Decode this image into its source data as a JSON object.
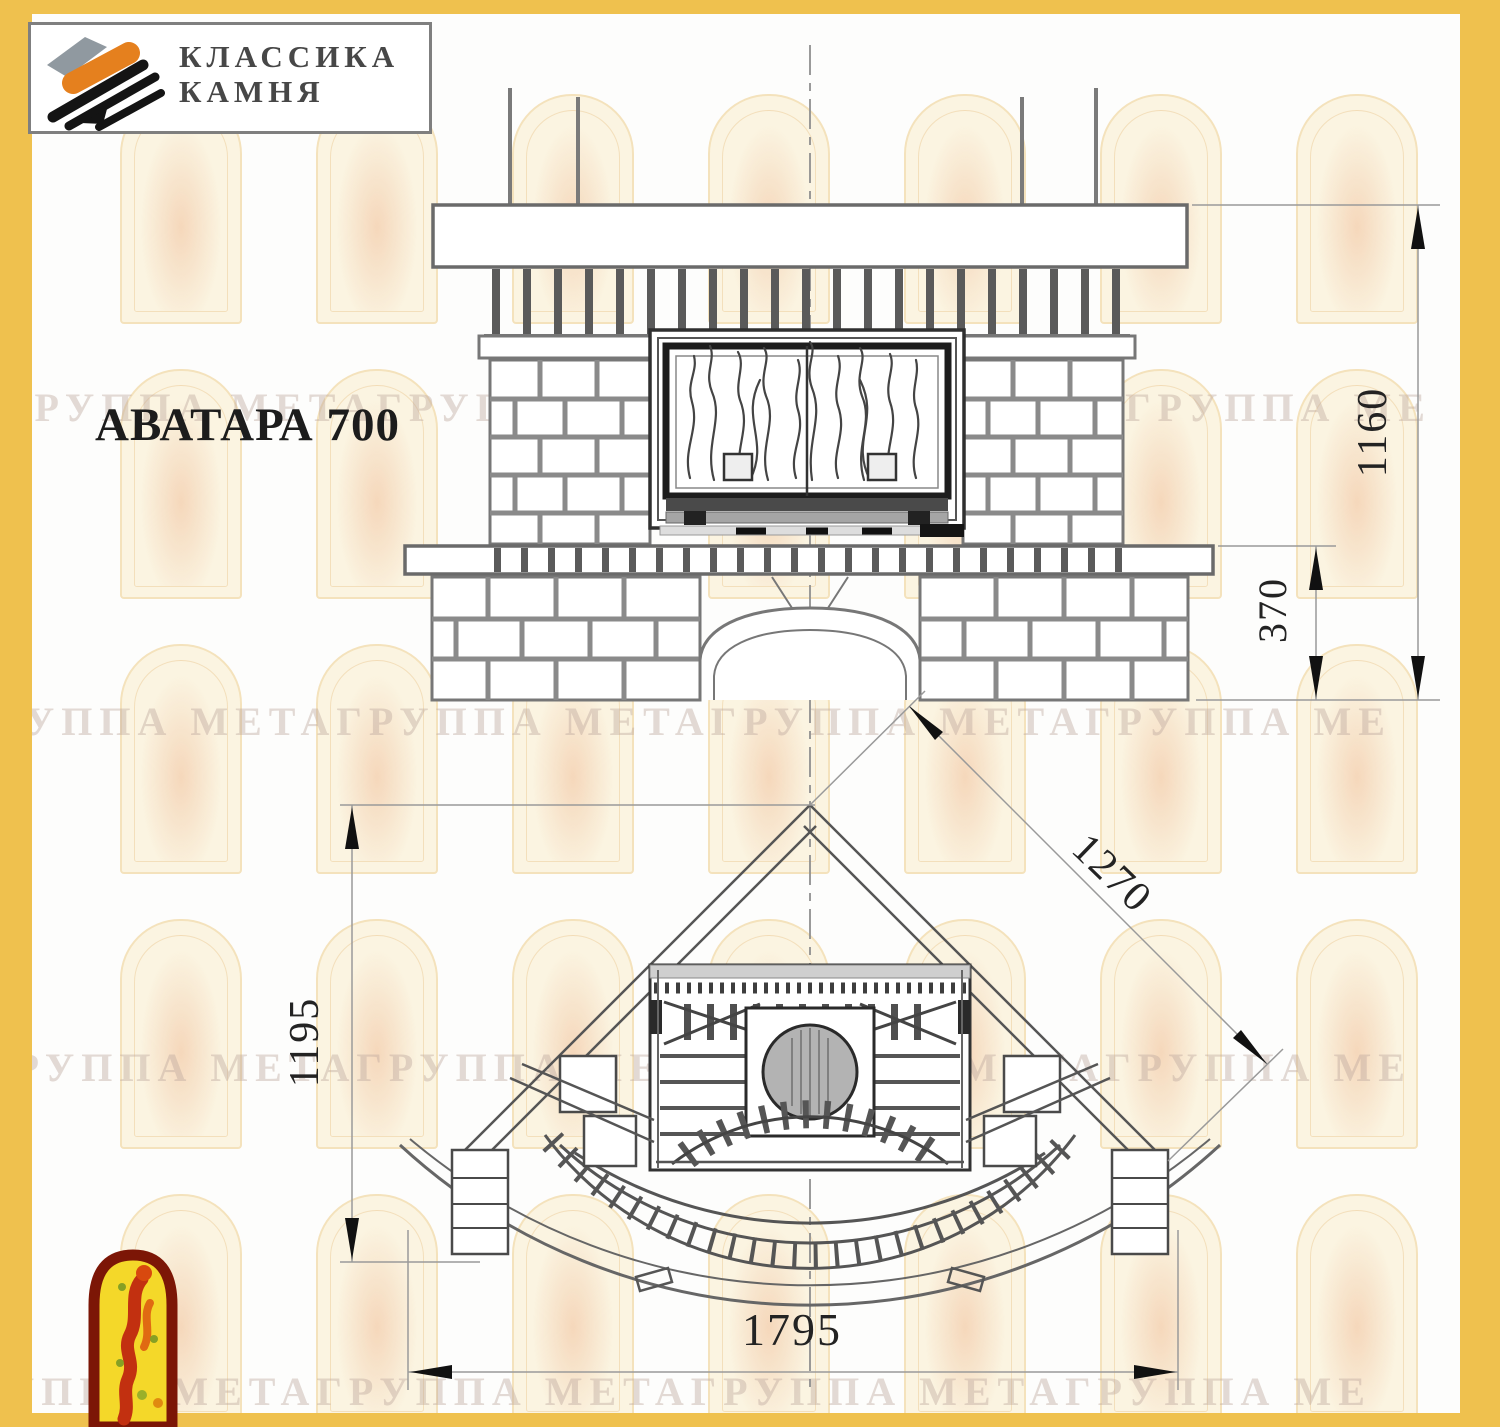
{
  "brand": {
    "name_line1": "КЛАССИКА",
    "name_line2": "КАМНЯ"
  },
  "title": "АВАТАРА 700",
  "drawing": {
    "front_view": {
      "description": "front elevation of corner fireplace with firebox flames, brick piers and arched wood niche",
      "dimensions": {
        "total_height": "1160",
        "hearth_height": "370"
      }
    },
    "plan_view": {
      "description": "top plan of corner fireplace with round flue and curved hearth steps",
      "dimensions": {
        "depth": "1195",
        "diagonal_width": "1270",
        "overall_width": "1795"
      }
    }
  },
  "watermark": {
    "row_text": "ГРУППА МЕТАГРУППА МЕТАГРУППА МЕТАГРУППА МЕТАГРУППА МЕТА",
    "arch_rows_y": [
      80,
      355,
      630,
      905,
      1180
    ],
    "arch_cols_x": [
      88,
      284,
      480,
      676,
      872,
      1068,
      1264
    ]
  },
  "colors": {
    "frame_yellow": "#efc14e",
    "logo_orange": "#e5801e",
    "logo_gray": "#9099a0",
    "emblem_red": "#c23010",
    "emblem_yellow": "#f4d829",
    "emblem_border": "#7c1606"
  }
}
